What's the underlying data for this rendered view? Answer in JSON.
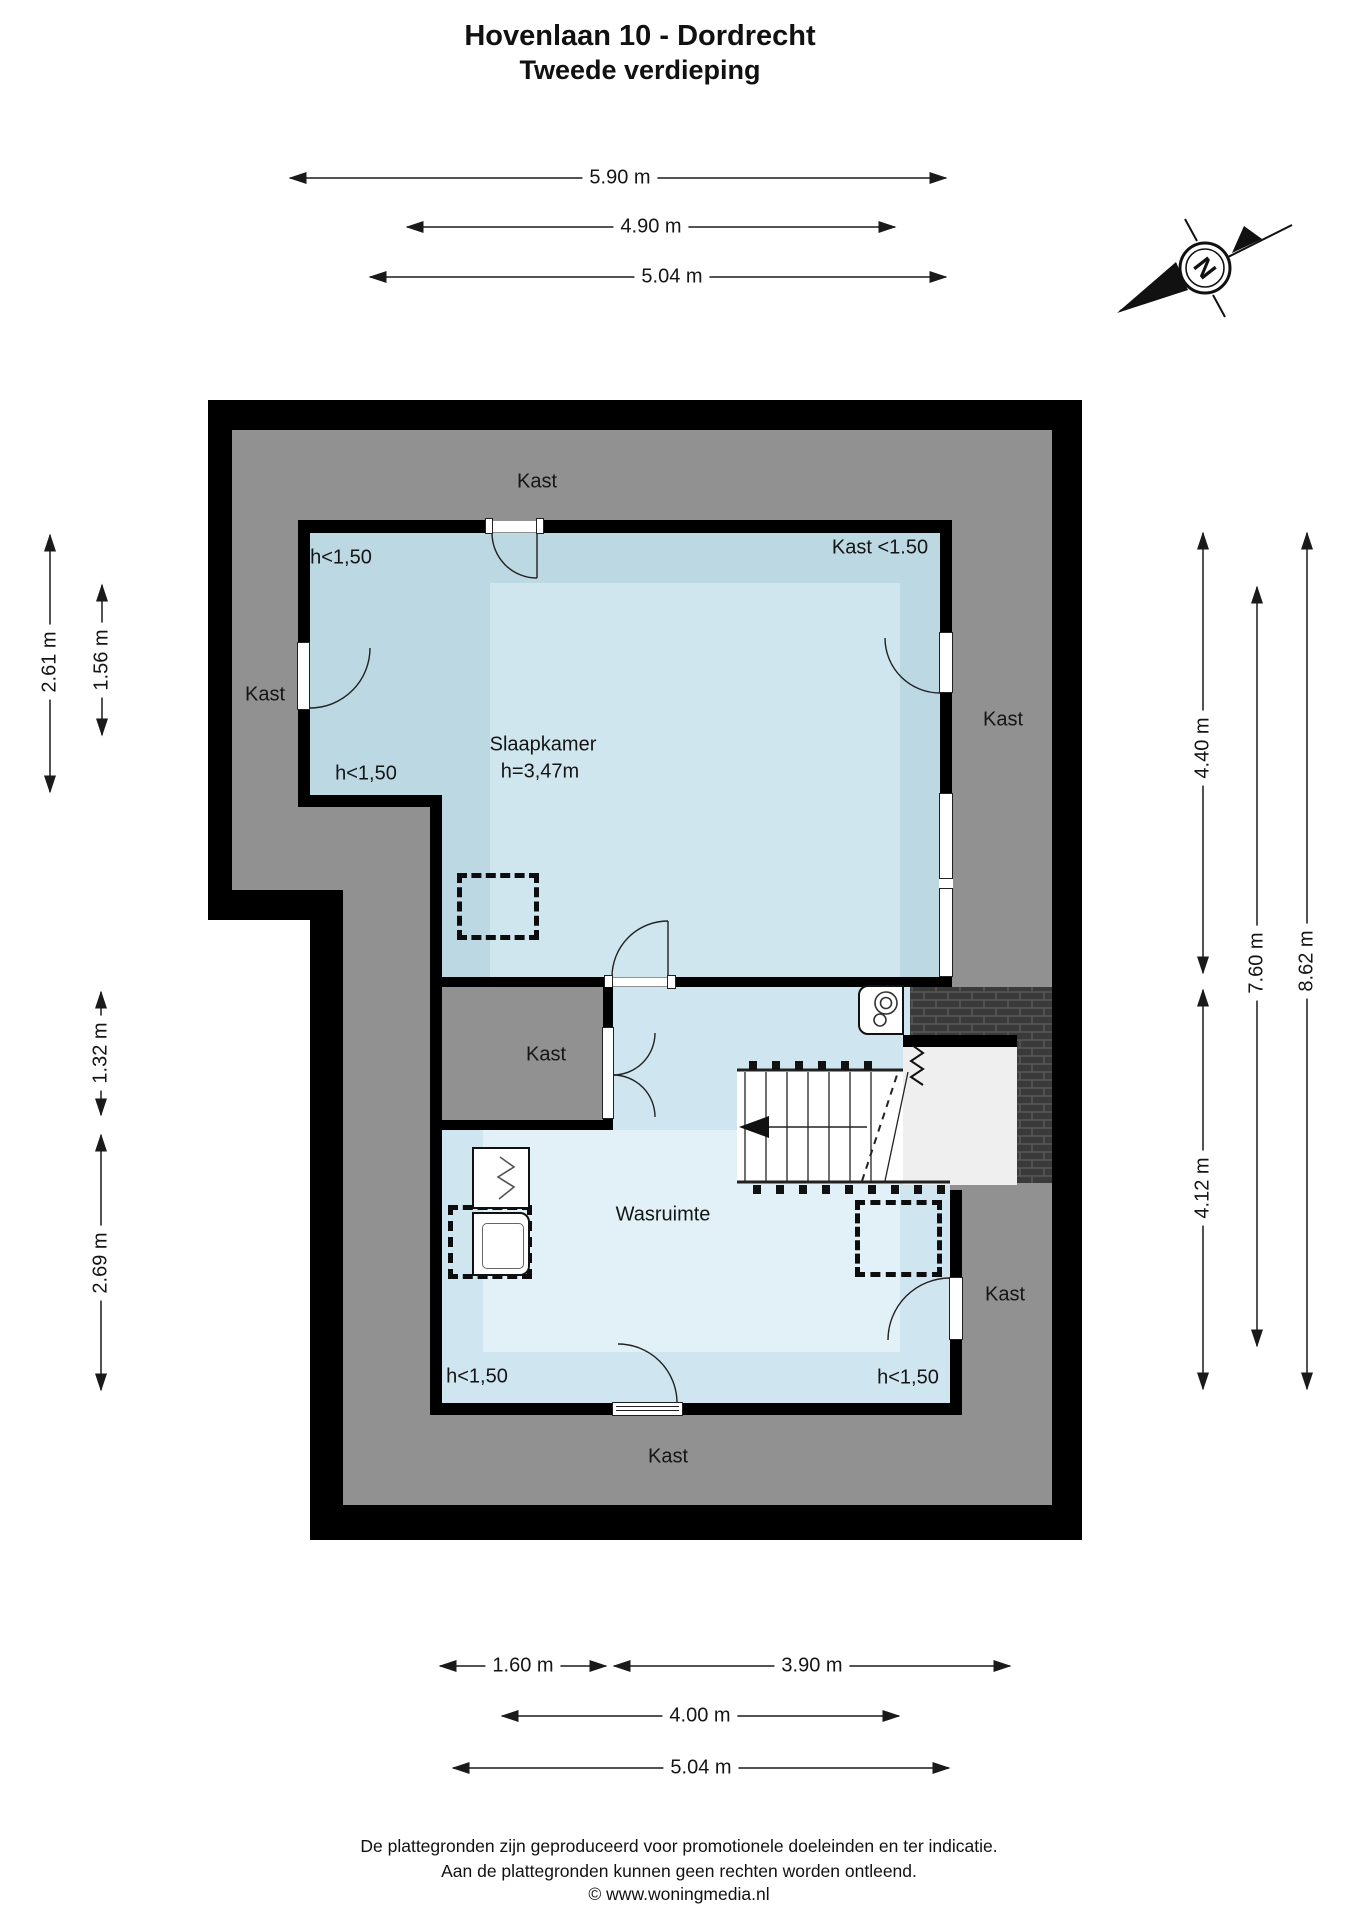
{
  "page": {
    "title_line1": "Hovenlaan 10 - Dordrecht",
    "title_line2": "Tweede verdieping"
  },
  "compass": {
    "letter": "N"
  },
  "rooms": {
    "slaapkamer": {
      "name": "Slaapkamer",
      "ceiling_height": "h=3,47m"
    },
    "wasruimte": {
      "name": "Wasruimte"
    }
  },
  "labels": {
    "kast_top": "Kast",
    "kast_left": "Kast",
    "kast_right_upper": "Kast",
    "kast_right_lower": "Kast",
    "kast_bottom": "Kast",
    "kast_closet": "Kast",
    "kast_lt150": "Kast <1.50",
    "h150_top": "h<1,50",
    "h150_mid": "h<1,50",
    "h150_bottom_left": "h<1,50",
    "h150_bottom_right": "h<1,50"
  },
  "dimensions": {
    "top": [
      "5.90 m",
      "4.90 m",
      "5.04 m"
    ],
    "left": [
      "2.61 m",
      "1.56 m",
      "1.32 m",
      "2.69 m"
    ],
    "right": [
      "4.40 m",
      "4.12 m",
      "7.60 m",
      "8.62 m"
    ],
    "bottom": [
      "1.60 m",
      "3.90 m",
      "4.00 m",
      "5.04 m"
    ]
  },
  "footer": {
    "line1": "De plattegronden zijn geproduceerd voor promotionele doeleinden en ter indicatie.",
    "line2": "Aan de plattegronden kunnen geen rechten worden ontleend.",
    "line3": "© www.woningmedia.nl"
  },
  "colors": {
    "wall": "#000000",
    "attic_gray": "#919191",
    "bedroom": "#bcd8e3",
    "bedroom_core": "#cfe6ee",
    "laundry": "#cfe5ef",
    "laundry_core": "#e2f1f7",
    "stair_white": "#ffffff",
    "landing_gray": "#efefef",
    "tile_dark": "#3a3a3a",
    "tile_grout": "#5c5c5c"
  }
}
